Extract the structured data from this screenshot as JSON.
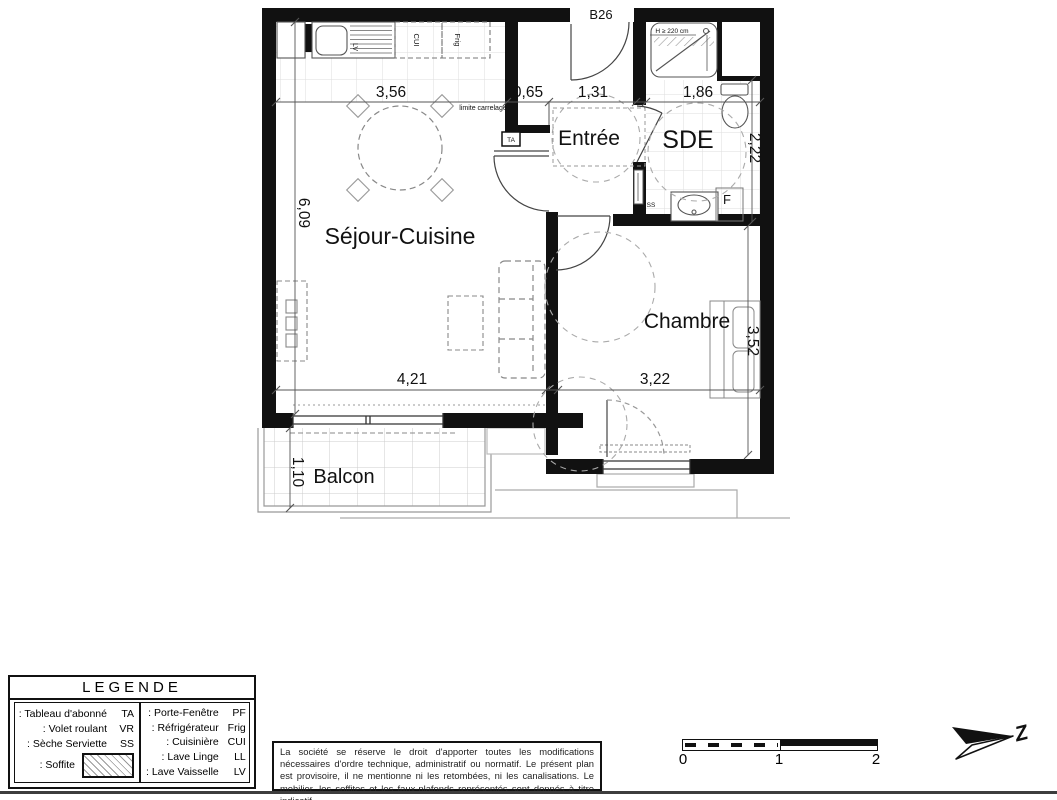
{
  "plan": {
    "unit": "B26",
    "rooms": {
      "sejour": "Séjour-Cuisine",
      "entree": "Entrée",
      "sde": "SDE",
      "chambre": "Chambre",
      "balcon": "Balcon"
    },
    "dims": {
      "kitchen_width": "3,56",
      "closet_width": "0,65",
      "entree_width": "1,31",
      "sde_width": "1,86",
      "sejour_height": "6,09",
      "sde_height": "2,22",
      "chambre_height": "3,52",
      "sejour_width": "4,21",
      "chambre_width": "3,22",
      "balcon_depth": "1,10"
    },
    "annotations": {
      "limite_carrelage": "limite carrelage",
      "shower_height": "H ≥ 220 cm",
      "ta": "TA",
      "ss": "SS",
      "f": "F",
      "cui": "CUI",
      "frig": "Frig",
      "lv": "LV"
    }
  },
  "legend": {
    "title": "LEGENDE",
    "left": [
      {
        "label": ": Tableau d'abonné",
        "code": "TA"
      },
      {
        "label": ": Volet roulant",
        "code": "VR"
      },
      {
        "label": ": Sèche Serviette",
        "code": "SS"
      },
      {
        "label": ": Soffite",
        "code": ""
      }
    ],
    "right": [
      {
        "label": ": Porte-Fenêtre",
        "code": "PF"
      },
      {
        "label": ": Réfrigérateur",
        "code": "Frig"
      },
      {
        "label": ": Cuisinière",
        "code": "CUI"
      },
      {
        "label": ": Lave Linge",
        "code": "LL"
      },
      {
        "label": ": Lave Vaisselle",
        "code": "LV"
      }
    ]
  },
  "disclaimer": "La société se réserve le droit d'apporter toutes les modifications nécessaires d'ordre technique, administratif ou normatif. Le présent plan est provisoire, il ne mentionne ni les retombées, ni les canalisations. Le mobilier, les soffites et les faux-plafonds représentés sont donnés à titre indicatif.",
  "scalebar": {
    "tick0": "0",
    "tick1": "1",
    "tick2": "2"
  },
  "north": {
    "letter": "Z"
  },
  "colors": {
    "wall": "#111111",
    "grid": "#dddddd",
    "furniture_dash": "#888888"
  }
}
